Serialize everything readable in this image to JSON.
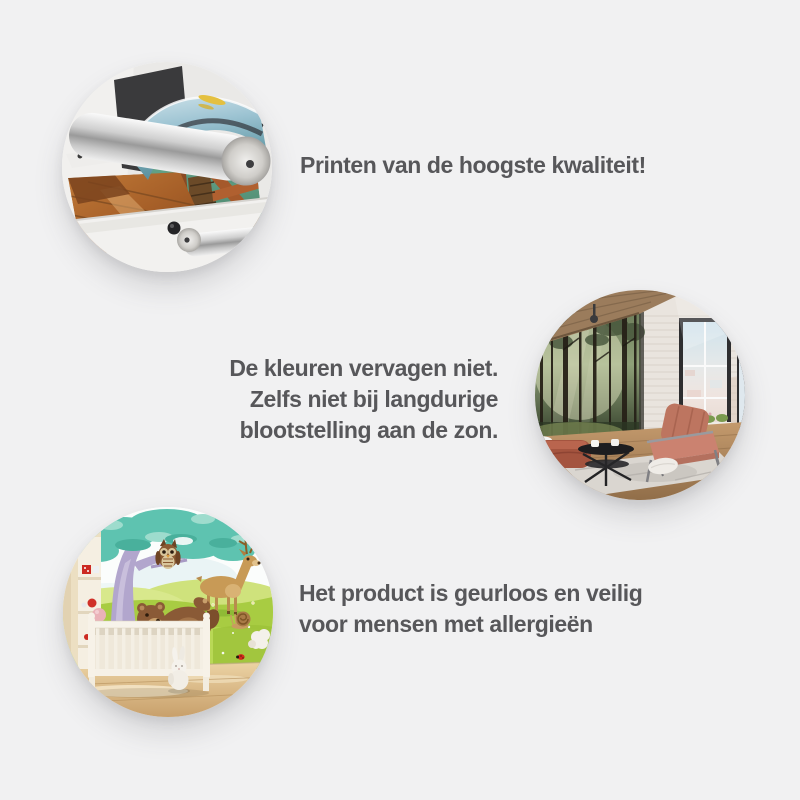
{
  "page": {
    "background_color": "#f1f1f2",
    "text_color": "#57575a"
  },
  "features": [
    {
      "id": "print-quality",
      "image": "printing-machine-photo",
      "lines": [
        "Printen van de hoogste kwaliteit!"
      ]
    },
    {
      "id": "fade-resistant",
      "image": "living-room-forest-mural-photo",
      "lines": [
        "De kleuren vervagen niet.",
        "Zelfs niet bij langdurige",
        "blootstelling aan de zon."
      ]
    },
    {
      "id": "odorless-allergy-safe",
      "image": "nursery-animal-mural-photo",
      "lines": [
        "Het product is geurloos en veilig",
        "voor mensen met allergieën"
      ]
    }
  ]
}
